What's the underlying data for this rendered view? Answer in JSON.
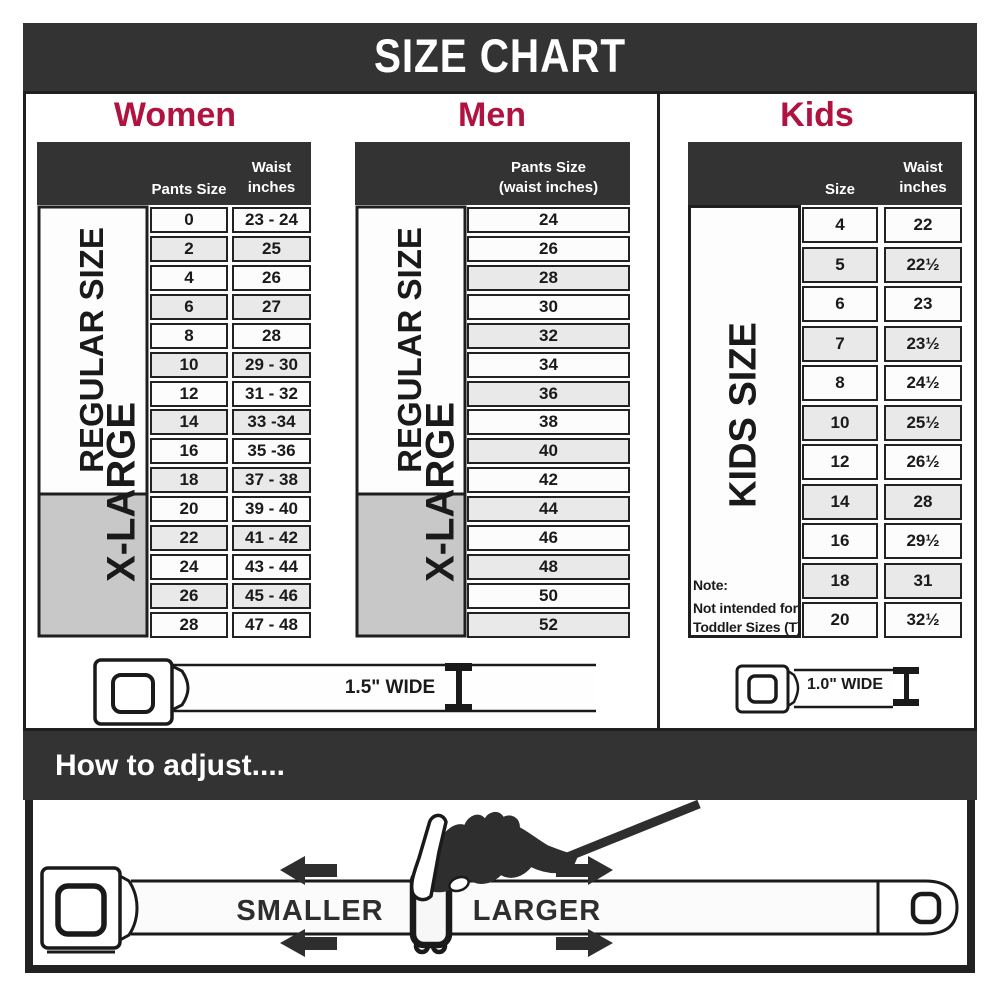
{
  "title": "SIZE CHART",
  "colors": {
    "accent": "#b11340",
    "dark": "#333333",
    "row_gray": "#e9e9e9",
    "row_white": "#fcfcfc",
    "range_gray": "#c8c8c8"
  },
  "women": {
    "heading": "Women",
    "col_size_header": "Pants Size",
    "col_waist_header_line1": "Waist",
    "col_waist_header_line2": "inches",
    "regular_label": "REGULAR SIZE",
    "xlarge_label": "X-LARGE",
    "belt_width_label": "1.5\" WIDE",
    "rows": [
      {
        "size": "0",
        "waist": "23 - 24"
      },
      {
        "size": "2",
        "waist": "25"
      },
      {
        "size": "4",
        "waist": "26"
      },
      {
        "size": "6",
        "waist": "27"
      },
      {
        "size": "8",
        "waist": "28"
      },
      {
        "size": "10",
        "waist": "29 - 30"
      },
      {
        "size": "12",
        "waist": "31 - 32"
      },
      {
        "size": "14",
        "waist": "33 -34"
      },
      {
        "size": "16",
        "waist": "35 -36"
      },
      {
        "size": "18",
        "waist": "37 - 38"
      },
      {
        "size": "20",
        "waist": "39 - 40"
      },
      {
        "size": "22",
        "waist": "41 - 42"
      },
      {
        "size": "24",
        "waist": "43 - 44"
      },
      {
        "size": "26",
        "waist": "45 - 46"
      },
      {
        "size": "28",
        "waist": "47 - 48"
      }
    ]
  },
  "men": {
    "heading": "Men",
    "col_header_line1": "Pants Size",
    "col_header_line2": "(waist inches)",
    "regular_label": "REGULAR SIZE",
    "xlarge_label": "X-LARGE",
    "rows": [
      "24",
      "26",
      "28",
      "30",
      "32",
      "34",
      "36",
      "38",
      "40",
      "42",
      "44",
      "46",
      "48",
      "50",
      "52"
    ]
  },
  "kids": {
    "heading": "Kids",
    "col_size_header": "Size",
    "col_waist_header_line1": "Waist",
    "col_waist_header_line2": "inches",
    "side_label": "KIDS SIZE",
    "belt_width_label": "1.0\" WIDE",
    "note_line1": "Note:",
    "note_line2": "Not intended for",
    "note_line3": "Toddler Sizes (T)",
    "rows": [
      {
        "size": "4",
        "waist": "22"
      },
      {
        "size": "5",
        "waist": "22½"
      },
      {
        "size": "6",
        "waist": "23"
      },
      {
        "size": "7",
        "waist": "23½"
      },
      {
        "size": "8",
        "waist": "24½"
      },
      {
        "size": "10",
        "waist": "25½"
      },
      {
        "size": "12",
        "waist": "26½"
      },
      {
        "size": "14",
        "waist": "28"
      },
      {
        "size": "16",
        "waist": "29½"
      },
      {
        "size": "18",
        "waist": "31"
      },
      {
        "size": "20",
        "waist": "32½"
      }
    ]
  },
  "adjust": {
    "heading": "How to adjust....",
    "smaller_label": "SMALLER",
    "larger_label": "LARGER"
  },
  "chart_data": [
    {
      "type": "table",
      "title": "Women",
      "columns": [
        "Pants Size",
        "Waist inches"
      ],
      "row_groups": {
        "REGULAR SIZE": [
          "0",
          "2",
          "4",
          "6",
          "8",
          "10",
          "12",
          "14",
          "16",
          "18"
        ],
        "X-LARGE": [
          "10",
          "12",
          "14",
          "16",
          "18",
          "20",
          "22",
          "24",
          "26",
          "28"
        ]
      },
      "rows": [
        [
          "0",
          "23 - 24"
        ],
        [
          "2",
          "25"
        ],
        [
          "4",
          "26"
        ],
        [
          "6",
          "27"
        ],
        [
          "8",
          "28"
        ],
        [
          "10",
          "29 - 30"
        ],
        [
          "12",
          "31 - 32"
        ],
        [
          "14",
          "33 -34"
        ],
        [
          "16",
          "35 -36"
        ],
        [
          "18",
          "37 - 38"
        ],
        [
          "20",
          "39 - 40"
        ],
        [
          "22",
          "41 - 42"
        ],
        [
          "24",
          "43 - 44"
        ],
        [
          "26",
          "45 - 46"
        ],
        [
          "28",
          "47 - 48"
        ]
      ],
      "belt_width": "1.5\" WIDE"
    },
    {
      "type": "table",
      "title": "Men",
      "columns": [
        "Pants Size (waist inches)"
      ],
      "row_groups": {
        "REGULAR SIZE": [
          "24",
          "26",
          "28",
          "30",
          "32",
          "34",
          "36",
          "38",
          "40",
          "42"
        ],
        "X-LARGE": [
          "34",
          "36",
          "38",
          "40",
          "42",
          "44",
          "46",
          "48",
          "50",
          "52"
        ]
      },
      "rows": [
        [
          "24"
        ],
        [
          "26"
        ],
        [
          "28"
        ],
        [
          "30"
        ],
        [
          "32"
        ],
        [
          "34"
        ],
        [
          "36"
        ],
        [
          "38"
        ],
        [
          "40"
        ],
        [
          "42"
        ],
        [
          "44"
        ],
        [
          "46"
        ],
        [
          "48"
        ],
        [
          "50"
        ],
        [
          "52"
        ]
      ],
      "belt_width": "1.5\" WIDE"
    },
    {
      "type": "table",
      "title": "Kids",
      "columns": [
        "Size",
        "Waist inches"
      ],
      "row_groups": {
        "KIDS SIZE": [
          "4",
          "5",
          "6",
          "7",
          "8",
          "10",
          "12",
          "14",
          "16",
          "18",
          "20"
        ]
      },
      "rows": [
        [
          "4",
          "22"
        ],
        [
          "5",
          "22½"
        ],
        [
          "6",
          "23"
        ],
        [
          "7",
          "23½"
        ],
        [
          "8",
          "24½"
        ],
        [
          "10",
          "25½"
        ],
        [
          "12",
          "26½"
        ],
        [
          "14",
          "28"
        ],
        [
          "16",
          "29½"
        ],
        [
          "18",
          "31"
        ],
        [
          "20",
          "32½"
        ]
      ],
      "note": "Note: Not intended for Toddler Sizes (T)",
      "belt_width": "1.0\" WIDE"
    }
  ]
}
